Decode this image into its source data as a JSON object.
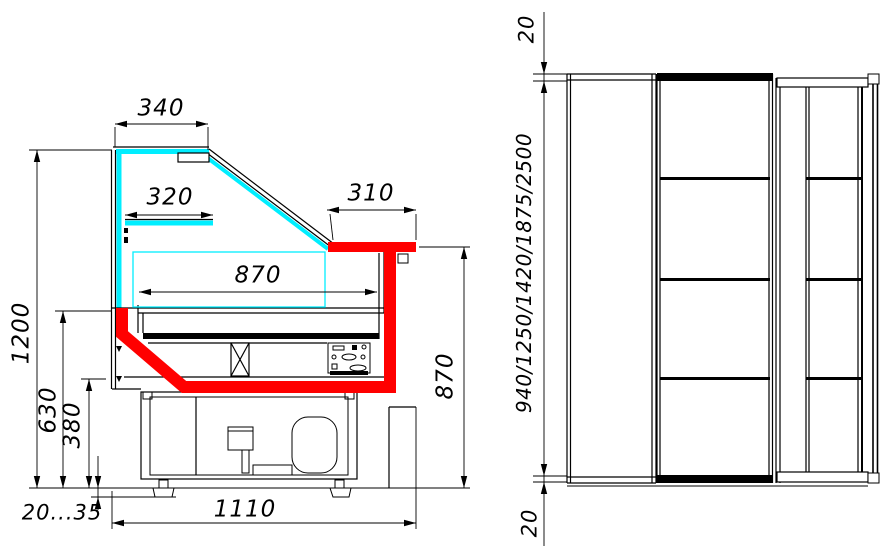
{
  "colors": {
    "accent_red": "#ff0000",
    "glass_cyan": "#00eeff",
    "line": "#000000",
    "background": "#ffffff"
  },
  "side_section_view": {
    "dimensions": {
      "canopy_depth": "340",
      "shelf_depth": "320",
      "rear_worktop_depth": "310",
      "display_well_width": "870",
      "overall_height": "1200",
      "front_panel_height": "630",
      "base_height": "380",
      "leg_height_range": "20...35",
      "overall_depth": "1110",
      "worktop_height": "870"
    }
  },
  "plan_view": {
    "dimensions": {
      "left_end_overhang": "20",
      "available_lengths": "940/1250/1420/1875/2500",
      "right_end_overhang": "20"
    }
  }
}
